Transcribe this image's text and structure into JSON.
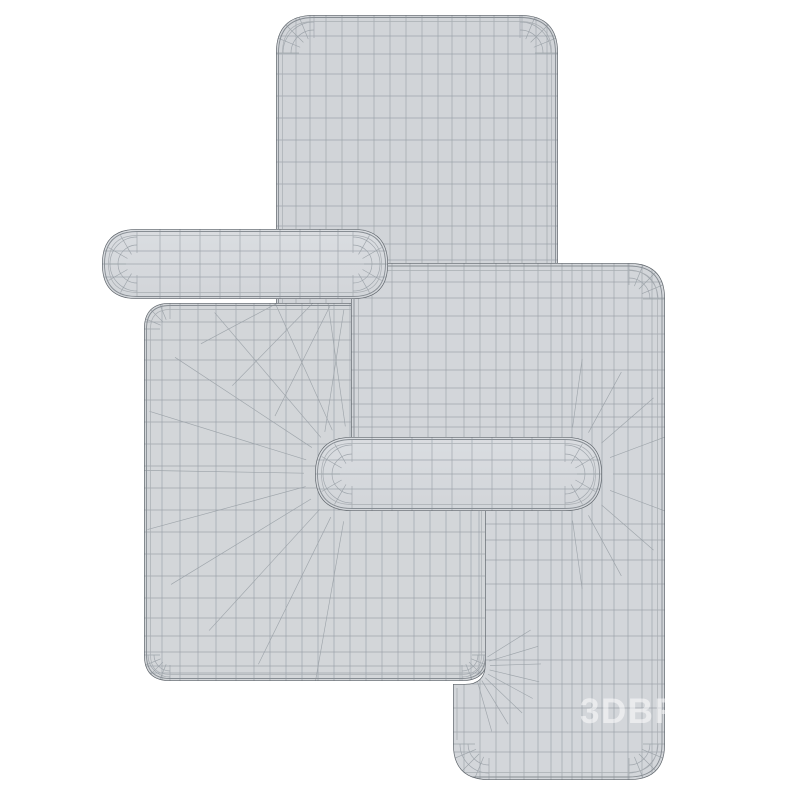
{
  "scene": {
    "description": "3D wireframe render of three overlapping rounded rectangular mats with pill-shaped handle bars",
    "watermark": {
      "text": "3DBR",
      "x": 580,
      "y": 723,
      "size": 35,
      "opacity": 0.52,
      "spacing": 1.5
    },
    "insets": [
      {
        "d": 2.5,
        "c": "contour",
        "w": 0.9
      },
      {
        "d": 6.5,
        "c": "loop",
        "w": 0.7
      }
    ],
    "shapes": [
      {
        "name": "mat-top",
        "kind": "rrect",
        "x": 276,
        "y": 15,
        "w": 282,
        "h": 440,
        "r": 38,
        "fill": "body1",
        "grid": {
          "vxs": [
            296,
            310,
            326,
            342,
            358,
            374,
            390,
            406,
            422,
            438,
            452,
            466,
            480,
            494,
            508,
            522,
            536,
            547
          ],
          "hys": [
            36,
            54,
            74,
            96,
            118,
            140,
            162,
            184,
            206,
            226,
            244,
            260,
            276,
            292,
            308,
            326,
            344,
            362,
            380,
            398,
            416,
            434
          ]
        },
        "fans": [
          {
            "cx": 314,
            "cy": 53,
            "a0": 180,
            "a1": 270,
            "n": 5,
            "r0": 15,
            "r1": 40
          },
          {
            "cx": 520,
            "cy": 53,
            "a0": 270,
            "a1": 360,
            "n": 5,
            "r0": 15,
            "r1": 40
          }
        ],
        "arcs": [
          {
            "cx": 314,
            "cy": 53,
            "rr": [
              23,
              31
            ],
            "a0": 180,
            "a1": 270
          },
          {
            "cx": 520,
            "cy": 53,
            "rr": [
              23,
              31
            ],
            "a0": 270,
            "a1": 360
          }
        ]
      },
      {
        "name": "mat-left-body",
        "kind": "rrect",
        "x": 144,
        "y": 303,
        "w": 344,
        "h": 378,
        "r": 26,
        "fill": "body2",
        "grid": {
          "vxs": [
            162,
            180,
            198,
            216,
            236,
            254,
            270,
            286,
            302,
            318,
            334,
            350,
            366,
            382,
            398,
            414,
            430,
            446,
            460,
            471,
            479
          ],
          "hys": [
            322,
            340,
            360,
            380,
            400,
            422,
            444,
            466,
            488,
            510,
            532,
            554,
            576,
            598,
            618,
            636,
            652,
            666,
            673
          ]
        },
        "fans": [
          {
            "cx": 352,
            "cy": 474,
            "a0": 100,
            "a1": 262,
            "n": 11,
            "r0": 48,
            "r1": 212
          },
          {
            "cx": 351,
            "cy": 264,
            "a0": 28,
            "a1": 152,
            "n": 8,
            "r0": 46,
            "r1": 170
          },
          {
            "cx": 170,
            "cy": 655,
            "a0": 90,
            "a1": 180,
            "n": 5,
            "r0": 10,
            "r1": 28
          },
          {
            "cx": 462,
            "cy": 655,
            "a0": 0,
            "a1": 90,
            "n": 5,
            "r0": 10,
            "r1": 28
          },
          {
            "cx": 170,
            "cy": 329,
            "a0": 180,
            "a1": 270,
            "n": 5,
            "r0": 10,
            "r1": 28
          }
        ],
        "arcs": [
          {
            "cx": 170,
            "cy": 655,
            "rr": [
              16,
              22
            ],
            "a0": 90,
            "a1": 180
          },
          {
            "cx": 462,
            "cy": 655,
            "rr": [
              16,
              22
            ],
            "a0": 0,
            "a1": 90
          }
        ]
      },
      {
        "name": "mat-right",
        "kind": "path",
        "bbox": {
          "x": 351,
          "y": 263,
          "w": 314,
          "h": 517
        },
        "path": "M 351 299 Q 351 263 387 263 L 629 263 Q 665 263 665 299 L 665 744 Q 665 780 629 780 L 489 780 Q 453 780 453 744 L 453 684 L 465 684 Q 485 684 485 664 L 485 505 L 351 505 Z",
        "fill": "body3",
        "loopRects": [
          {
            "x": 354,
            "y": 266,
            "w": 308,
            "h": 511,
            "r": 33
          },
          {
            "x": 358.5,
            "y": 270.5,
            "w": 299,
            "h": 502,
            "r": 30
          }
        ],
        "grid": {
          "vxs": [
            372,
            392,
            410,
            428,
            446,
            464,
            480,
            496,
            510,
            524,
            538,
            551,
            562,
            572,
            582,
            592,
            602,
            614,
            628,
            642,
            652
          ],
          "hys": [
            282,
            298,
            316,
            334,
            352,
            370,
            388,
            404,
            417,
            427,
            524,
            540,
            560,
            584,
            610,
            636,
            660,
            684,
            708,
            732,
            752
          ]
        },
        "segments": [
          [
            481,
            516,
            481,
            660
          ],
          [
            477,
            519,
            477,
            657
          ],
          [
            457,
            688,
            457,
            740
          ]
        ],
        "fans": [
          {
            "cx": 566,
            "cy": 474,
            "a0": -82,
            "a1": 82,
            "n": 9,
            "r0": 47,
            "r1": 116
          },
          {
            "cx": 473,
            "cy": 666,
            "a0": -32,
            "a1": 74,
            "n": 8,
            "r0": 17,
            "r1": 68
          },
          {
            "cx": 629,
            "cy": 299,
            "a0": 270,
            "a1": 360,
            "n": 5,
            "r0": 14,
            "r1": 38
          },
          {
            "cx": 629,
            "cy": 744,
            "a0": 0,
            "a1": 90,
            "n": 5,
            "r0": 14,
            "r1": 38
          },
          {
            "cx": 489,
            "cy": 744,
            "a0": 90,
            "a1": 180,
            "n": 5,
            "r0": 14,
            "r1": 38
          }
        ],
        "arcs": [
          {
            "cx": 629,
            "cy": 299,
            "rr": [
              21,
              29
            ],
            "a0": 270,
            "a1": 360
          },
          {
            "cx": 629,
            "cy": 744,
            "rr": [
              21,
              29
            ],
            "a0": 0,
            "a1": 90
          },
          {
            "cx": 489,
            "cy": 744,
            "rr": [
              21,
              29
            ],
            "a0": 90,
            "a1": 180
          }
        ],
        "watermark": true
      },
      {
        "name": "mat-left-handle",
        "kind": "rrect",
        "x": 102,
        "y": 229,
        "w": 286,
        "h": 70,
        "r": 35,
        "fill": "pill",
        "pill": true,
        "grid": {
          "vxs": [
            160,
            180,
            200,
            220,
            240,
            260,
            280,
            300,
            320,
            338
          ],
          "hys": [
            251,
            264,
            277
          ]
        },
        "fans": [
          {
            "cx": 137,
            "cy": 264,
            "a0": 90,
            "a1": 270,
            "n": 7,
            "r0": 11,
            "r1": 33
          },
          {
            "cx": 353,
            "cy": 264,
            "a0": -90,
            "a1": 90,
            "n": 7,
            "r0": 11,
            "r1": 33
          }
        ],
        "arcs": [
          {
            "cx": 137,
            "cy": 264,
            "rr": [
              19,
              27
            ],
            "a0": 90,
            "a1": 270
          },
          {
            "cx": 353,
            "cy": 264,
            "rr": [
              19,
              27
            ],
            "a0": -90,
            "a1": 90
          }
        ]
      },
      {
        "name": "mat-right-handle",
        "kind": "rrect",
        "x": 315,
        "y": 437,
        "w": 287,
        "h": 74,
        "r": 37,
        "fill": "pill",
        "pill": true,
        "grid": {
          "vxs": [
            372,
            392,
            412,
            432,
            452,
            472,
            492,
            512,
            532,
            550
          ],
          "hys": [
            460,
            474,
            489
          ]
        },
        "fans": [
          {
            "cx": 352,
            "cy": 474,
            "a0": 90,
            "a1": 270,
            "n": 7,
            "r0": 12,
            "r1": 35
          },
          {
            "cx": 565,
            "cy": 474,
            "a0": -90,
            "a1": 90,
            "n": 7,
            "r0": 12,
            "r1": 35
          }
        ],
        "arcs": [
          {
            "cx": 352,
            "cy": 474,
            "rr": [
              20,
              29
            ],
            "a0": 90,
            "a1": 270
          },
          {
            "cx": 565,
            "cy": 474,
            "rr": [
              20,
              29
            ],
            "a0": -90,
            "a1": 90
          }
        ]
      }
    ]
  },
  "palette": {
    "bg": "#ffffff",
    "body1": "#d1d4d8",
    "body2": "#d3d6d9",
    "body3": "#d3d6da",
    "pill_hi": "#dadde1",
    "pill_lo": "#d2d5d9",
    "outline": "#5f656b",
    "contour": "#878d93",
    "loop": "#a9aeb3",
    "grid": "#9aa1a8",
    "fan": "#99a0a6",
    "watermark_color": "#ffffff"
  }
}
